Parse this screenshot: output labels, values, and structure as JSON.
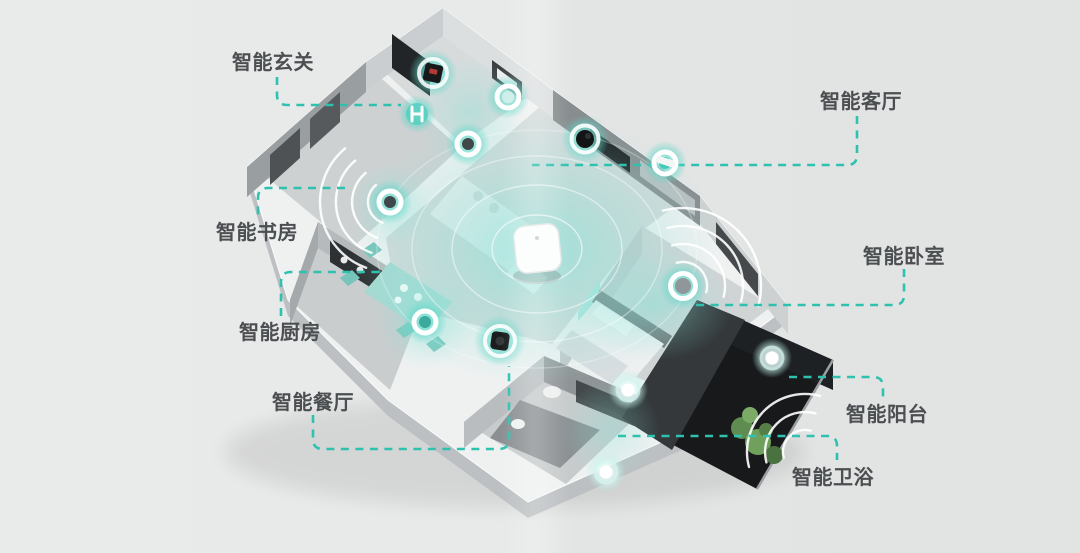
{
  "labels": {
    "entrance": "智能玄关",
    "living": "智能客厅",
    "study": "智能书房",
    "kitchen": "智能厨房",
    "dining": "智能餐厅",
    "bedroom": "智能卧室",
    "balcony": "智能阳台",
    "bathroom": "智能卫浴"
  },
  "devices": {
    "hub": "central-control-hub",
    "entrance_panel": "smart-control-panel",
    "entrance_lock": "smart-door-lock",
    "entrance_light": "ceiling-light",
    "living_speaker": "smart-speaker",
    "living_camera": "security-camera",
    "living_controller": "wall-controller",
    "study_speaker": "wireless-speaker",
    "kitchen_sensor": "smart-sensor",
    "vacuum": "robot-vacuum",
    "bedroom_sensor": "smart-sensor",
    "balcony_light": "smart-light",
    "bathroom_light_upper": "smart-light",
    "bathroom_light_lower": "smart-light"
  },
  "colors": {
    "accent_teal": "#2fc1af",
    "glow_teal": "#7fe3d6",
    "label_text": "#4c4f51",
    "background": "#e7e8e8",
    "balcony_floor": "#17191b"
  }
}
